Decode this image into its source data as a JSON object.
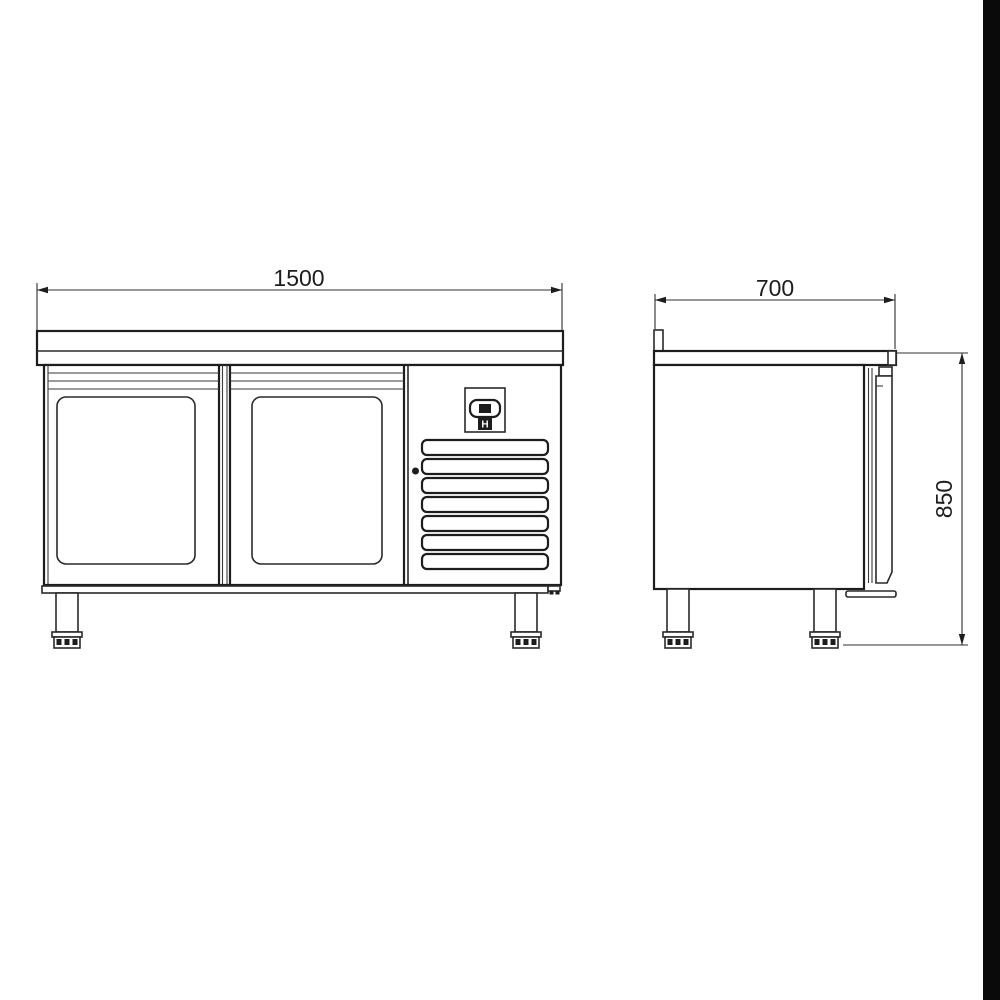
{
  "page": {
    "background_color": "#ffffff",
    "scan_edge_strip_color": "#0a0a0a"
  },
  "drawing": {
    "subject": "Two-door refrigerated counter - dimensioned technical drawing (front and side elevation)",
    "line_color": "#1d1d1d",
    "front_view": {
      "width_dimension_label": "1500",
      "door_count": 2,
      "louvre_slat_count": 7,
      "controller_label": "H"
    },
    "side_view": {
      "depth_dimension_label": "700",
      "height_dimension_label": "850"
    }
  }
}
